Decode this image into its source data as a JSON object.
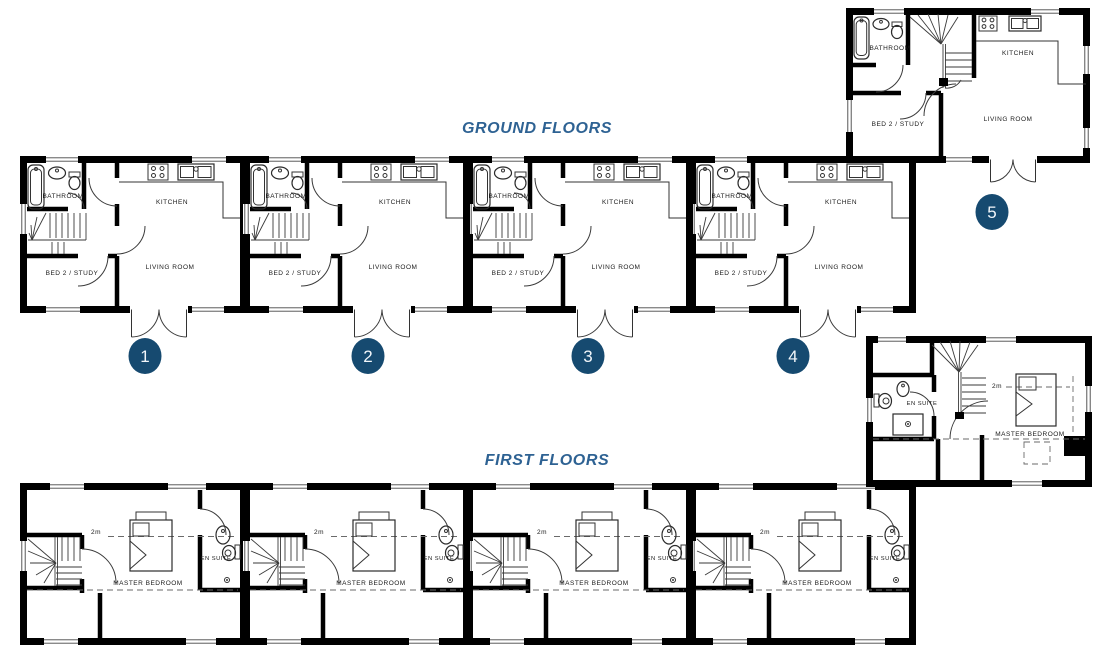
{
  "titles": {
    "ground": "GROUND FLOORS",
    "first": "FIRST FLOORS"
  },
  "rooms": {
    "bathroom": "BATHROOM",
    "kitchen": "KITCHEN",
    "living_room": "LIVING ROOM",
    "bed2_study": "BED 2 / STUDY",
    "master_bedroom": "MASTER BEDROOM",
    "en_suite": "EN SUITE",
    "height_marker": "2m"
  },
  "units": {
    "labels": [
      "1",
      "2",
      "3",
      "4",
      "5"
    ]
  },
  "colors": {
    "title_blue": "#2e6293",
    "badge_navy": "#164a70",
    "wall_black": "#000000"
  }
}
